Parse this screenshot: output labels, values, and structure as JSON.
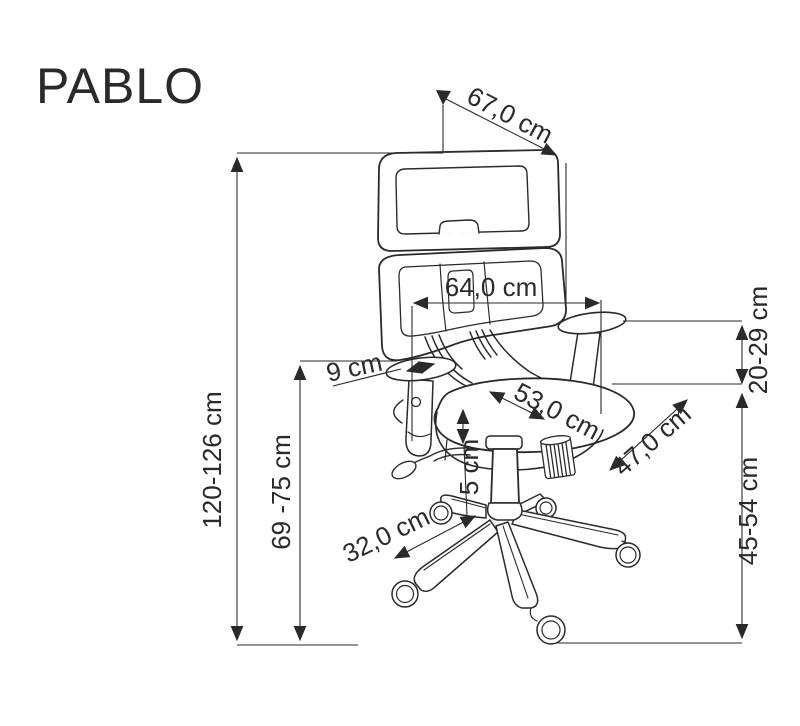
{
  "title": "PABLO",
  "colors": {
    "ink": "#2b2a29",
    "background": "#ffffff"
  },
  "diagram": {
    "subject": "office-swivel-chair-technical-dimension-drawing",
    "units": "cm",
    "dimensions": [
      {
        "id": "headrest-width-diagonal",
        "label": "67,0 cm"
      },
      {
        "id": "backrest-width",
        "label": "64,0 cm"
      },
      {
        "id": "total-height",
        "label": "120-126 cm"
      },
      {
        "id": "backrest-height",
        "label": "69 -75 cm"
      },
      {
        "id": "armrest-pad-width",
        "label": "9 cm"
      },
      {
        "id": "seat-depth",
        "label": "53,0 cm"
      },
      {
        "id": "seat-width",
        "label": "47,0 cm"
      },
      {
        "id": "armrest-height-range",
        "label": "20-29 cm"
      },
      {
        "id": "seat-height-range",
        "label": "45-54 cm"
      },
      {
        "id": "base-leg-length",
        "label": "32,0 cm"
      },
      {
        "id": "gas-lift-stroke",
        "label": "5 cm"
      }
    ]
  }
}
